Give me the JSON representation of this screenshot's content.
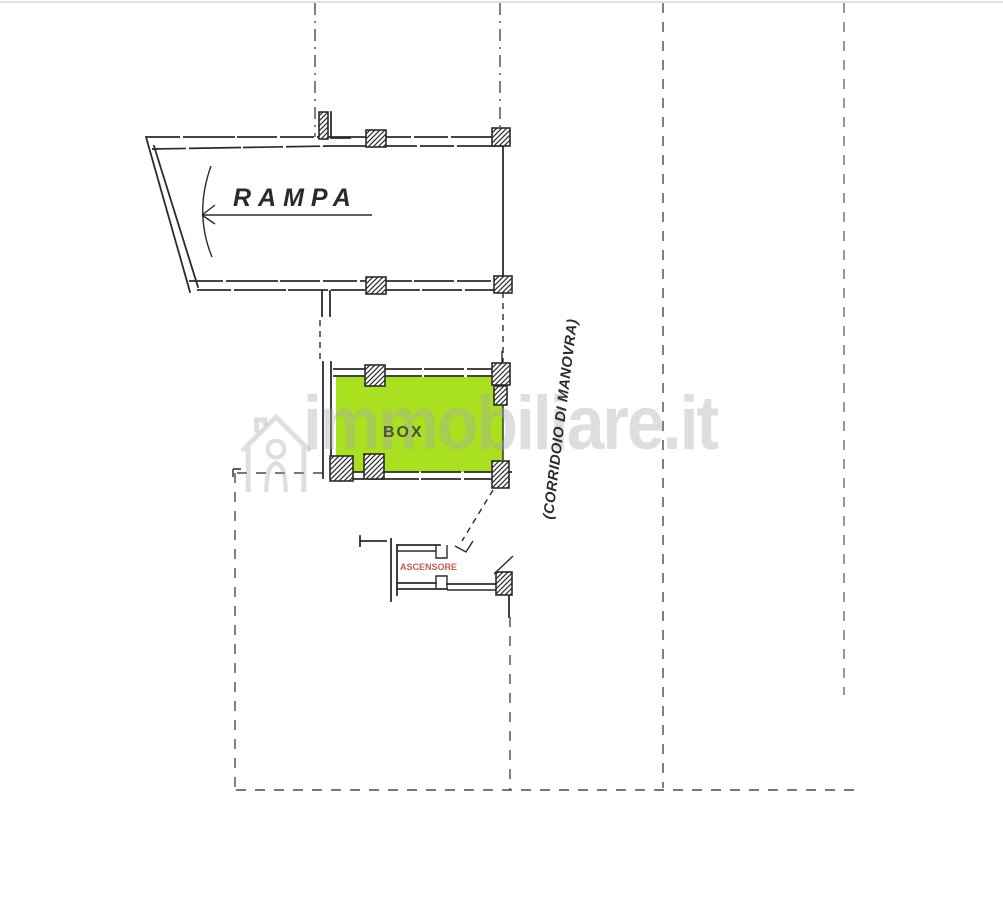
{
  "page": {
    "background": "#ffffff",
    "description": "Scanned garage floor plan (planimetria) with highlighted parking box"
  },
  "plan": {
    "labels": {
      "ramp": "RAMPA",
      "box": "BOX",
      "corridor": "(CORRIDOIO DI MANOVRA)",
      "elevator": "ASCENSORE"
    },
    "colors": {
      "line": "#2b2b2b",
      "section_line": "#4a4a4a",
      "box_fill": "#a9e01f",
      "box_label": "#49503c",
      "elevator_text": "#c95b55",
      "watermark": "rgba(168,168,168,0.38)"
    }
  },
  "watermark": {
    "text": "immobiliare.it",
    "logo": "immobiliare-house-icon"
  }
}
